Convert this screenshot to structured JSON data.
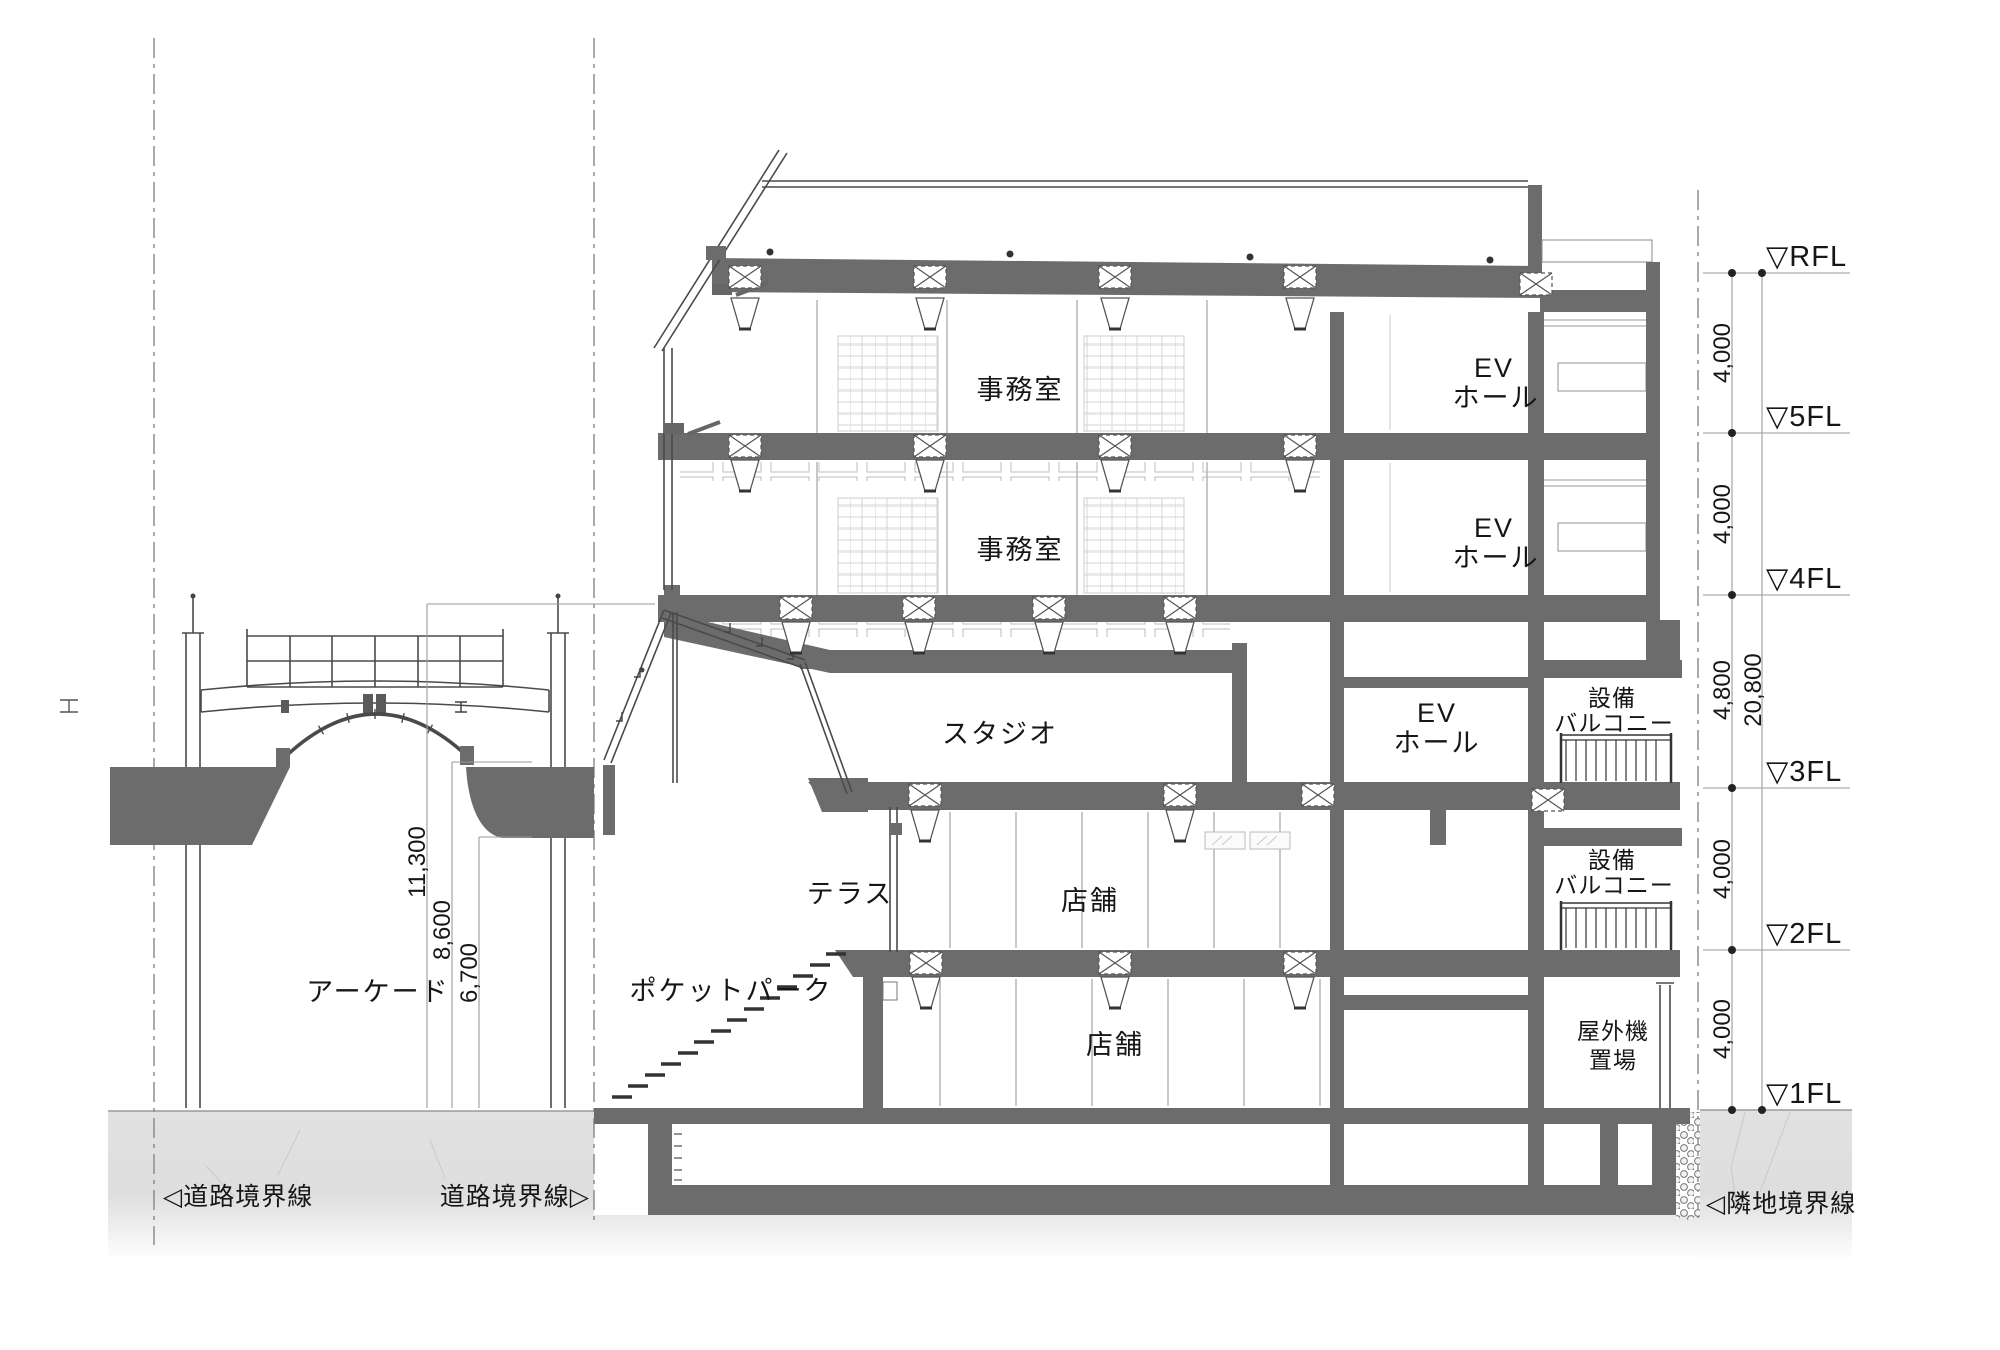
{
  "rooms": {
    "office_5f": "事務室",
    "office_4f": "事務室",
    "ev_5f": {
      "l1": "EV",
      "l2": "ホール"
    },
    "ev_4f": {
      "l1": "EV",
      "l2": "ホール"
    },
    "ev_3f": {
      "l1": "EV",
      "l2": "ホール"
    },
    "studio": "スタジオ",
    "equip_balcony_3f": {
      "l1": "設備",
      "l2": "バルコニー"
    },
    "equip_balcony_2f": {
      "l1": "設備",
      "l2": "バルコニー"
    },
    "terrace": "テラス",
    "shop_2f": "店舗",
    "shop_1f": "店舗",
    "pocket_park": "ポケットパーク",
    "outdoor_units": {
      "l1": "屋外機",
      "l2": "置場"
    },
    "arcade": "アーケード"
  },
  "levels": {
    "rfl": "▽RFL",
    "f5": "▽5FL",
    "f4": "▽4FL",
    "f3": "▽3FL",
    "f2": "▽2FL",
    "f1": "▽1FL"
  },
  "dimensions": {
    "floor_heights": [
      "4,000",
      "4,000",
      "4,800",
      "4,000",
      "4,000"
    ],
    "total_height": "20,800",
    "arcade_heights": [
      "11,300",
      "8,600",
      "6,700"
    ]
  },
  "boundaries": {
    "road_left": "◁道路境界線",
    "road_right": "道路境界線▷",
    "adjacent": "◁隣地境界線"
  }
}
